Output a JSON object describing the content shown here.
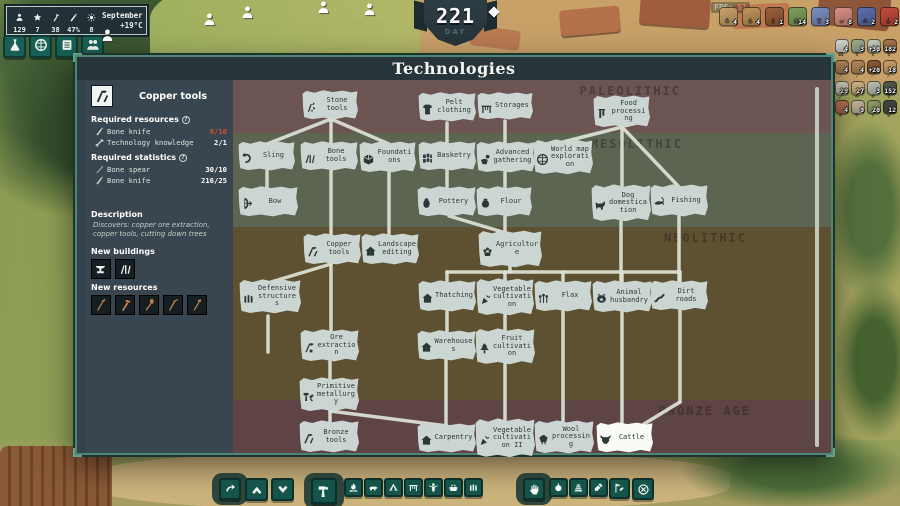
{
  "hud": {
    "stats": [
      {
        "icon": "person",
        "value": "129"
      },
      {
        "icon": "star",
        "value": "7"
      },
      {
        "icon": "axe",
        "value": "38"
      },
      {
        "icon": "knife",
        "value": "47%"
      },
      {
        "icon": "sun",
        "value": "8"
      }
    ],
    "season": "September",
    "temperature": "+19°C",
    "day_value": "221",
    "day_label": "DAY",
    "fps_label": "FPS:",
    "fps_value": "51",
    "quick_buttons": [
      {
        "id": "science",
        "icon": "flask"
      },
      {
        "id": "world",
        "icon": "globe"
      },
      {
        "id": "reports",
        "icon": "scroll"
      },
      {
        "id": "villagers",
        "icon": "people"
      }
    ],
    "top_resources": [
      {
        "icon": "pouch",
        "count": "4",
        "color": "#c9a36a"
      },
      {
        "icon": "sack",
        "count": "4",
        "color": "#c2955d"
      },
      {
        "icon": "jug",
        "count": "1",
        "color": "#9c5f3a"
      },
      {
        "icon": "basket",
        "count": "14",
        "color": "#7da05a"
      },
      {
        "icon": "cloth",
        "count": "3",
        "color": "#7b8fc0"
      },
      {
        "icon": "meat",
        "count": "8",
        "color": "#d98f85"
      },
      {
        "icon": "berries",
        "count": "2",
        "color": "#5d6fae"
      },
      {
        "icon": "apple",
        "count": "2",
        "color": "#c44b3c"
      }
    ],
    "side_resources": [
      [
        {
          "icon": "crate",
          "count": "4",
          "color": "#d8dcd4"
        },
        {
          "icon": "tunic",
          "count": "3",
          "color": "#9fae8f"
        },
        {
          "icon": "tunic",
          "count": "+30",
          "color": "#c3cdbb"
        },
        {
          "icon": "tunic",
          "count": "182",
          "color": "#a8764d"
        }
      ],
      [
        {
          "icon": "pickaxe",
          "count": "4",
          "color": "#b78a5a"
        },
        {
          "icon": "axe",
          "count": "4",
          "color": "#b78a5a"
        },
        {
          "icon": "spear",
          "count": "+20",
          "color": "#8a5c38"
        },
        {
          "icon": "knife",
          "count": "18",
          "color": "#caa06a"
        }
      ],
      [
        {
          "icon": "bone",
          "count": "29",
          "color": "#e3ddc8"
        },
        {
          "icon": "eggs",
          "count": "27",
          "color": "#d8b985"
        },
        {
          "icon": "stone",
          "count": "3",
          "color": "#b9c0b4"
        },
        {
          "icon": "pants",
          "count": "152",
          "color": "#56594e"
        }
      ],
      [
        {
          "icon": "meat",
          "count": "4",
          "color": "#c47b5a"
        },
        {
          "icon": "hide",
          "count": "9",
          "color": "#cabc9e"
        },
        {
          "icon": "herb",
          "count": "20",
          "color": "#8fa06a"
        },
        {
          "icon": "coal",
          "count": "12",
          "color": "#45483f"
        }
      ]
    ]
  },
  "panel": {
    "title": "Technologies",
    "sidebar": {
      "selected_tech": "Copper tools",
      "selected_tech_icon": "tools",
      "required_resources_label": "Required resources",
      "required_resources": [
        {
          "icon": "knife",
          "name": "Bone knife",
          "value": "8/10",
          "insufficient": true
        },
        {
          "icon": "bone",
          "name": "Technology knowledge",
          "value": "2/1",
          "insufficient": false
        }
      ],
      "required_statistics_label": "Required statistics",
      "required_statistics": [
        {
          "icon": "spear",
          "name": "Bone spear",
          "value": "30/10"
        },
        {
          "icon": "knife",
          "name": "Bone knife",
          "value": "216/25"
        }
      ],
      "description_label": "Description",
      "description": "Discovers: copper ore extraction, copper tools, cutting down trees",
      "new_buildings_label": "New buildings",
      "new_buildings": [
        "anvil",
        "bone-tools"
      ],
      "new_resources_label": "New resources",
      "new_resources": [
        "adze",
        "axe",
        "spade",
        "pickaxe",
        "hoe"
      ]
    },
    "eras": [
      {
        "name": "PALEOLITHIC",
        "color": "#6b5452",
        "top": 23,
        "height": 53,
        "label_right": 150
      },
      {
        "name": "MESOLITHIC",
        "color": "#5c6452",
        "top": 76,
        "height": 94,
        "label_right": 148
      },
      {
        "name": "NEOLITHIC",
        "color": "#5e5132",
        "top": 170,
        "height": 173,
        "label_right": 84
      },
      {
        "name": "BRONZE AGE",
        "color": "#5e4444",
        "top": 343,
        "height": 53,
        "label_right": 80
      }
    ],
    "edge_color": "#dde3d7",
    "nodes": [
      {
        "id": "stone-tools",
        "label": "Stone tools",
        "icon": "stone-tools",
        "x": 302,
        "y": 90,
        "w": 56,
        "h": 30
      },
      {
        "id": "pelt-clothing",
        "label": "Pelt clothing",
        "icon": "pelt",
        "x": 418,
        "y": 92,
        "w": 58,
        "h": 30
      },
      {
        "id": "storages",
        "label": "Storages",
        "icon": "rack",
        "x": 477,
        "y": 92,
        "w": 56,
        "h": 28
      },
      {
        "id": "food-processing",
        "label": "Food processing",
        "icon": "food-processing",
        "x": 593,
        "y": 95,
        "w": 57,
        "h": 33
      },
      {
        "id": "sling",
        "label": "Sling",
        "icon": "sling",
        "x": 238,
        "y": 141,
        "w": 57,
        "h": 30
      },
      {
        "id": "bone-tools",
        "label": "Bone tools",
        "icon": "bone-tools",
        "x": 300,
        "y": 141,
        "w": 58,
        "h": 30
      },
      {
        "id": "foundations",
        "label": "Foundations",
        "icon": "cube",
        "x": 359,
        "y": 141,
        "w": 57,
        "h": 32
      },
      {
        "id": "basketry",
        "label": "Basketry",
        "icon": "weave",
        "x": 418,
        "y": 141,
        "w": 58,
        "h": 30
      },
      {
        "id": "advanced-gathering",
        "label": "Advanced gathering",
        "icon": "hand-berry",
        "x": 476,
        "y": 141,
        "w": 59,
        "h": 32
      },
      {
        "id": "world-map-exploration",
        "label": "World map exploration",
        "icon": "globe",
        "x": 533,
        "y": 139,
        "w": 60,
        "h": 36
      },
      {
        "id": "bow",
        "label": "Bow",
        "icon": "bow",
        "x": 238,
        "y": 186,
        "w": 60,
        "h": 31
      },
      {
        "id": "pottery",
        "label": "Pottery",
        "icon": "pot",
        "x": 417,
        "y": 186,
        "w": 59,
        "h": 31
      },
      {
        "id": "flour",
        "label": "Flour",
        "icon": "sack",
        "x": 476,
        "y": 186,
        "w": 56,
        "h": 31
      },
      {
        "id": "dog-domestication",
        "label": "Dog domestication",
        "icon": "dog",
        "x": 591,
        "y": 184,
        "w": 60,
        "h": 38
      },
      {
        "id": "fishing",
        "label": "Fishing",
        "icon": "fish",
        "x": 650,
        "y": 184,
        "w": 58,
        "h": 33
      },
      {
        "id": "copper-tools",
        "label": "Copper tools",
        "icon": "tools",
        "x": 303,
        "y": 233,
        "w": 58,
        "h": 32
      },
      {
        "id": "landscape-editing",
        "label": "Landscape editing",
        "icon": "house",
        "x": 361,
        "y": 233,
        "w": 58,
        "h": 32
      },
      {
        "id": "agriculture",
        "label": "Agriculture",
        "icon": "sheaf",
        "x": 478,
        "y": 230,
        "w": 64,
        "h": 38
      },
      {
        "id": "defensive-structures",
        "label": "Defensive structures",
        "icon": "pales",
        "x": 239,
        "y": 279,
        "w": 62,
        "h": 35
      },
      {
        "id": "thatching",
        "label": "Thatching",
        "icon": "house",
        "x": 418,
        "y": 280,
        "w": 58,
        "h": 32
      },
      {
        "id": "vegetable-cultivation",
        "label": "Vegetable cultivation",
        "icon": "carrot",
        "x": 476,
        "y": 278,
        "w": 58,
        "h": 38
      },
      {
        "id": "flax",
        "label": "Flax",
        "icon": "flax",
        "x": 534,
        "y": 280,
        "w": 58,
        "h": 32
      },
      {
        "id": "animal-husbandry",
        "label": "Animal husbandry",
        "icon": "pig",
        "x": 592,
        "y": 280,
        "w": 60,
        "h": 33
      },
      {
        "id": "dirt-roads",
        "label": "Dirt roads",
        "icon": "road",
        "x": 650,
        "y": 280,
        "w": 58,
        "h": 31
      },
      {
        "id": "ore-extraction",
        "label": "Ore extraction",
        "icon": "ore",
        "x": 300,
        "y": 329,
        "w": 59,
        "h": 33
      },
      {
        "id": "warehouses",
        "label": "Warehouses",
        "icon": "house",
        "x": 417,
        "y": 330,
        "w": 59,
        "h": 31
      },
      {
        "id": "fruit-cultivation",
        "label": "Fruit cultivation",
        "icon": "tree",
        "x": 475,
        "y": 328,
        "w": 60,
        "h": 37
      },
      {
        "id": "primitive-metallurgy",
        "label": "Primitive metallurgy",
        "icon": "hammers",
        "x": 299,
        "y": 377,
        "w": 60,
        "h": 35
      },
      {
        "id": "bronze-tools",
        "label": "Bronze tools",
        "icon": "tools",
        "x": 299,
        "y": 420,
        "w": 60,
        "h": 33
      },
      {
        "id": "carpentry",
        "label": "Carpentry",
        "icon": "house",
        "x": 417,
        "y": 423,
        "w": 59,
        "h": 30
      },
      {
        "id": "vegetable-cultivation-ii",
        "label": "Vegetable cultivation II",
        "icon": "carrot",
        "x": 475,
        "y": 418,
        "w": 60,
        "h": 40
      },
      {
        "id": "wool-processing",
        "label": "Wool processing",
        "icon": "wool",
        "x": 534,
        "y": 420,
        "w": 60,
        "h": 34
      },
      {
        "id": "cattle",
        "label": "Cattle",
        "icon": "cow",
        "x": 596,
        "y": 422,
        "w": 57,
        "h": 31,
        "hl": true
      }
    ],
    "edges": [
      [
        331,
        119,
        267,
        144
      ],
      [
        331,
        119,
        331,
        144
      ],
      [
        331,
        119,
        389,
        144
      ],
      [
        447,
        123,
        447,
        144
      ],
      [
        505,
        121,
        505,
        144
      ],
      [
        622,
        127,
        563,
        142
      ],
      [
        622,
        127,
        622,
        188
      ],
      [
        622,
        127,
        680,
        188
      ],
      [
        267,
        170,
        267,
        189
      ],
      [
        331,
        170,
        331,
        236
      ],
      [
        389,
        172,
        389,
        236
      ],
      [
        447,
        170,
        447,
        189
      ],
      [
        505,
        172,
        505,
        189
      ],
      [
        449,
        216,
        506,
        233
      ],
      [
        505,
        216,
        505,
        233
      ],
      [
        621,
        221,
        621,
        283
      ],
      [
        679,
        216,
        679,
        283
      ],
      [
        331,
        264,
        271,
        282
      ],
      [
        331,
        264,
        331,
        332
      ],
      [
        510,
        262,
        510,
        272
      ],
      [
        447,
        272,
        680,
        272
      ],
      [
        447,
        272,
        447,
        283
      ],
      [
        505,
        272,
        505,
        283
      ],
      [
        563,
        272,
        563,
        283
      ],
      [
        622,
        272,
        622,
        283
      ],
      [
        680,
        272,
        680,
        283
      ],
      [
        447,
        311,
        447,
        333
      ],
      [
        505,
        315,
        505,
        331
      ],
      [
        563,
        311,
        563,
        423
      ],
      [
        622,
        312,
        622,
        424
      ],
      [
        680,
        310,
        680,
        402
      ],
      [
        680,
        402,
        644,
        424
      ],
      [
        330,
        361,
        330,
        380
      ],
      [
        330,
        411,
        330,
        423
      ],
      [
        330,
        411,
        447,
        426
      ],
      [
        446,
        360,
        446,
        425
      ],
      [
        505,
        364,
        505,
        420
      ],
      [
        268,
        316,
        268,
        352
      ]
    ]
  },
  "toolbar": {
    "buttons": [
      {
        "id": "rotate",
        "icon": "rotate",
        "x": 219,
        "w": 22,
        "blob": true
      },
      {
        "id": "raise-terrain",
        "icon": "chev-up",
        "x": 245,
        "w": 23
      },
      {
        "id": "lower-terrain",
        "icon": "chev-down",
        "x": 271,
        "w": 23
      },
      {
        "id": "build",
        "icon": "hammer",
        "x": 311,
        "w": 26,
        "blob": true
      },
      {
        "id": "campfire",
        "icon": "campfire",
        "x": 344,
        "w": 19
      },
      {
        "id": "livestock",
        "icon": "boar",
        "x": 364,
        "w": 19
      },
      {
        "id": "tent",
        "icon": "tent",
        "x": 384,
        "w": 19
      },
      {
        "id": "drying-rack",
        "icon": "rack",
        "x": 404,
        "w": 19
      },
      {
        "id": "idol",
        "icon": "idol",
        "x": 424,
        "w": 19
      },
      {
        "id": "gathering-spot",
        "icon": "hands",
        "x": 444,
        "w": 19
      },
      {
        "id": "palisade",
        "icon": "pales",
        "x": 464,
        "w": 19
      },
      {
        "id": "orders",
        "icon": "hand",
        "x": 523,
        "w": 22,
        "blob": true
      },
      {
        "id": "harvest",
        "icon": "onion",
        "x": 549,
        "w": 19
      },
      {
        "id": "stockpile",
        "icon": "layers",
        "x": 569,
        "w": 19
      },
      {
        "id": "dig",
        "icon": "shovel",
        "x": 589,
        "w": 19
      },
      {
        "id": "claim",
        "icon": "flagpick",
        "x": 609,
        "w": 21
      },
      {
        "id": "cancel",
        "icon": "circle-x",
        "x": 632,
        "w": 22
      }
    ]
  }
}
